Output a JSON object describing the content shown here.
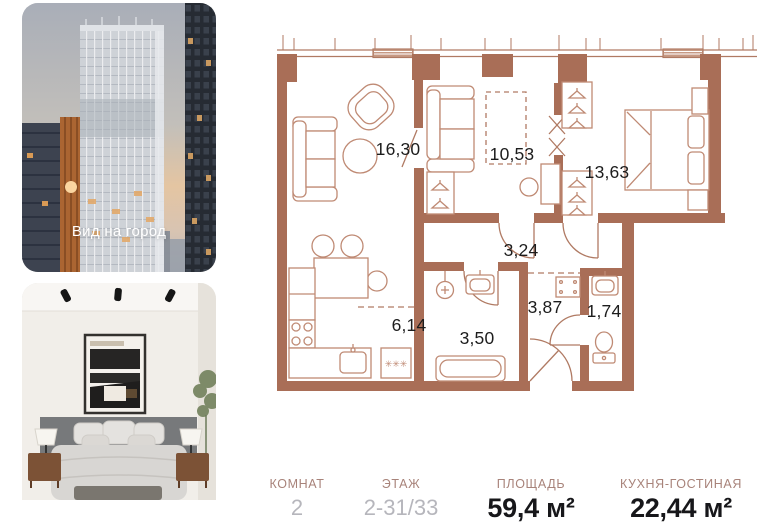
{
  "photos": {
    "city_card": {
      "caption": "Вид на город"
    },
    "bedroom_card": {}
  },
  "floorplan": {
    "rooms": [
      {
        "id": "living-room",
        "area": "16,30"
      },
      {
        "id": "room-second",
        "area": "10,53"
      },
      {
        "id": "bedroom-master",
        "area": "13,63"
      },
      {
        "id": "corridor",
        "area": "3,24"
      },
      {
        "id": "kitchen",
        "area": "6,14"
      },
      {
        "id": "bathroom",
        "area": "3,50"
      },
      {
        "id": "hallway",
        "area": "3,87"
      },
      {
        "id": "wc",
        "area": "1,74"
      }
    ],
    "washer_symbol": "✳✳✳",
    "colors": {
      "wall": "#a96e57",
      "furniture": "#bf8a74"
    }
  },
  "summary": {
    "columns": [
      {
        "label": "КОМНАТ",
        "value": "2"
      },
      {
        "label": "ЭТАЖ",
        "value": "2-31/33"
      },
      {
        "label": "ПЛОЩАДЬ",
        "value": "59,4 м²"
      },
      {
        "label": "КУХНЯ-ГОСТИНАЯ",
        "value": "22,44 м²"
      }
    ]
  }
}
